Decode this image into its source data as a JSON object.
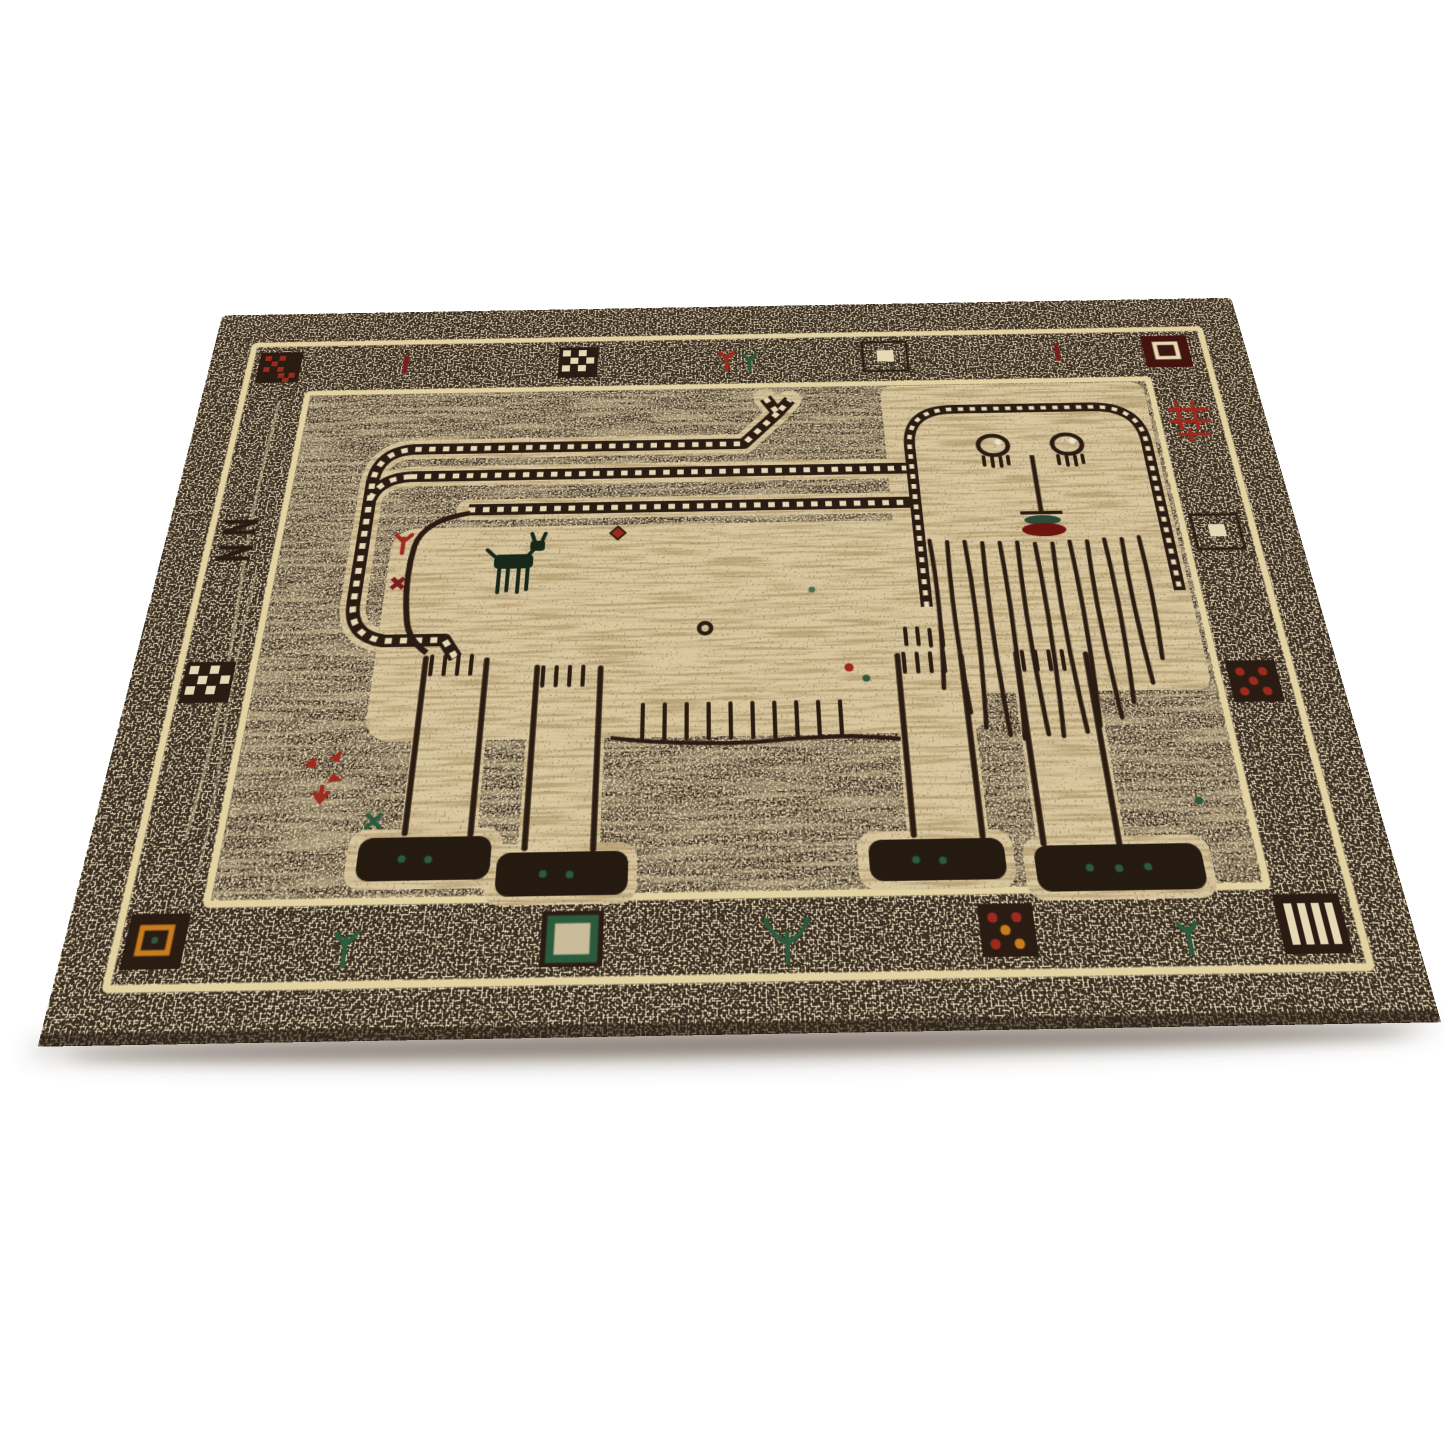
{
  "scene": {
    "type": "product photograph",
    "subject": "Hand-knotted tribal Gabbeh wool rug with a pictorial lion, photographed at an angle on a plain white background",
    "background_color": "#ffffff",
    "view": "square rug seen in perspective: near edge wide, far edge narrow, soft shadow under the front edge"
  },
  "colors": {
    "bg": "#ffffff",
    "ink": "#2a1c12",
    "outer": "#3a2d20",
    "field": "#6f5f4c",
    "body": "#d9c7a0",
    "speck": "#e7d9b6",
    "stripe": "#e3d2a2",
    "streak": "#b29a6c",
    "red": "#9c2a1e",
    "dred": "#7a1d1d",
    "maroon": "#431310",
    "green": "#2c5a3c",
    "dgreen": "#1e3d2b",
    "orange": "#c87c1e",
    "eyeg": "#2f5c44",
    "mouth": "#6e1410",
    "foot": "#241a10",
    "goat": "#17281a",
    "shadow": "#6b5a49"
  },
  "rug": {
    "shape": "square, shown as a trapezoid by the camera angle",
    "border": {
      "outer_band": "dark brown and ivory salt-and-pepper mottle",
      "guard_stripes": "two thin ivory-gold lines framing the motif band on all four sides",
      "top_motifs": [
        "dark square with red pixel crosses (corner)",
        "dark red bar",
        "dark and ivory checkered square",
        "red and green sprigs",
        "dark green square with ivory center",
        "dark red bar",
        "maroon square with ivory inner square (corner)"
      ],
      "right_motifs": [
        "red lattice motif",
        "dark green square with ivory center",
        "dark square with red dots",
        "dark square with ivory stripes (corner)"
      ],
      "bottom_motifs": [
        "dark square with orange inner square (corner)",
        "green sprig",
        "dark square with green inner frame",
        "green plant sprig",
        "dark square with red and orange dots",
        "green sprig"
      ],
      "left_motifs": [
        "stacked dark zigzag strokes",
        "dark and ivory checkered square",
        "pale vertical abrash streaks"
      ]
    },
    "field": {
      "ground": "mottled grey-brown salt-and-pepper with horizontal abrash streaks",
      "lion": {
        "body": "ivory body with tan streaks, facing right",
        "face": "rectangular face framed by a ladder border; two green eyes with lashes and white glints; long nose line; green upper and maroon lower mouth",
        "mane": "long wavy vertical mane strands hanging below the face",
        "tail": "railroad-track tail doubled back over the body, curling down at the left, tip forked at top",
        "back": "railroad-track back line running into the head frame",
        "legs": "four legs with comb fringes at the hips and dark feet tipped with green dots",
        "belly": "row of comb fringe marks under the belly"
      },
      "secondary_figures": [
        "small dark goat standing on the lion's body"
      ],
      "scatter_motifs": [
        "red floret and maroon cross inside tail curl",
        "red diamond on the back",
        "small dark ring",
        "red and green dots on the chest",
        "red pinwheel flower lower left",
        "green cross near rear foot",
        "green dot near front foot"
      ]
    }
  }
}
